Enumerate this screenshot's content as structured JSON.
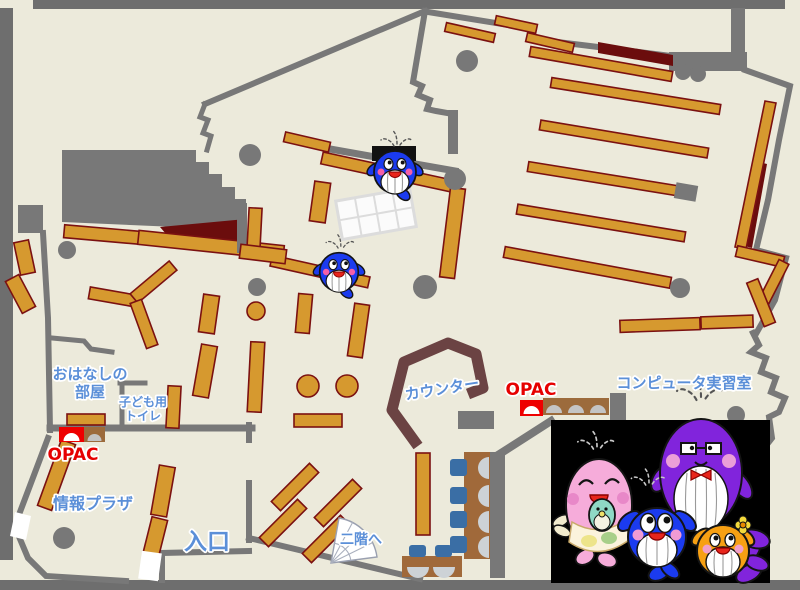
{
  "labels": {
    "story_room_line1": "おはなしの",
    "story_room_line2": "部屋",
    "kids_toilet_line1": "子ども用",
    "kids_toilet_line2": "トイレ",
    "info_plaza": "情報プラザ",
    "entrance": "入口",
    "to_second_floor": "二階へ",
    "counter": "カウンター",
    "opac": "OPAC",
    "computer_room": "コンピュータ実習室"
  },
  "facilities": {
    "opac_childrens_area": {
      "label": "OPAC",
      "machines": 2
    },
    "opac_counter": {
      "label": "OPAC",
      "machines": 4
    }
  },
  "markers": {
    "whale_mascots_on_map": 2,
    "mascot_photo_characters": [
      "pink-whale",
      "baby-whale",
      "blue-whale",
      "purple-whale",
      "orange-whale"
    ]
  },
  "colors": {
    "floor": "#ECEADB",
    "wall_gray": "#787878",
    "frame_gray": "#6E6E6E",
    "shelf_orange": "#D6992F",
    "shelf_border": "#7B1111",
    "dark_red_area": "#6B0D0D",
    "counter_brown": "#6B4343",
    "label_blue": "#5B8FD8",
    "opac_red": "#E60000",
    "chair_blue": "#3A6EA5",
    "desk_brown": "#A0693A",
    "photo_background": "#000000",
    "mascot_blue": "#1B3BEF",
    "mascot_pink": "#F6ACDA",
    "mascot_purple": "#8124DC",
    "mascot_orange": "#F7A013",
    "mascot_baby_green": "#8FD9C5"
  }
}
